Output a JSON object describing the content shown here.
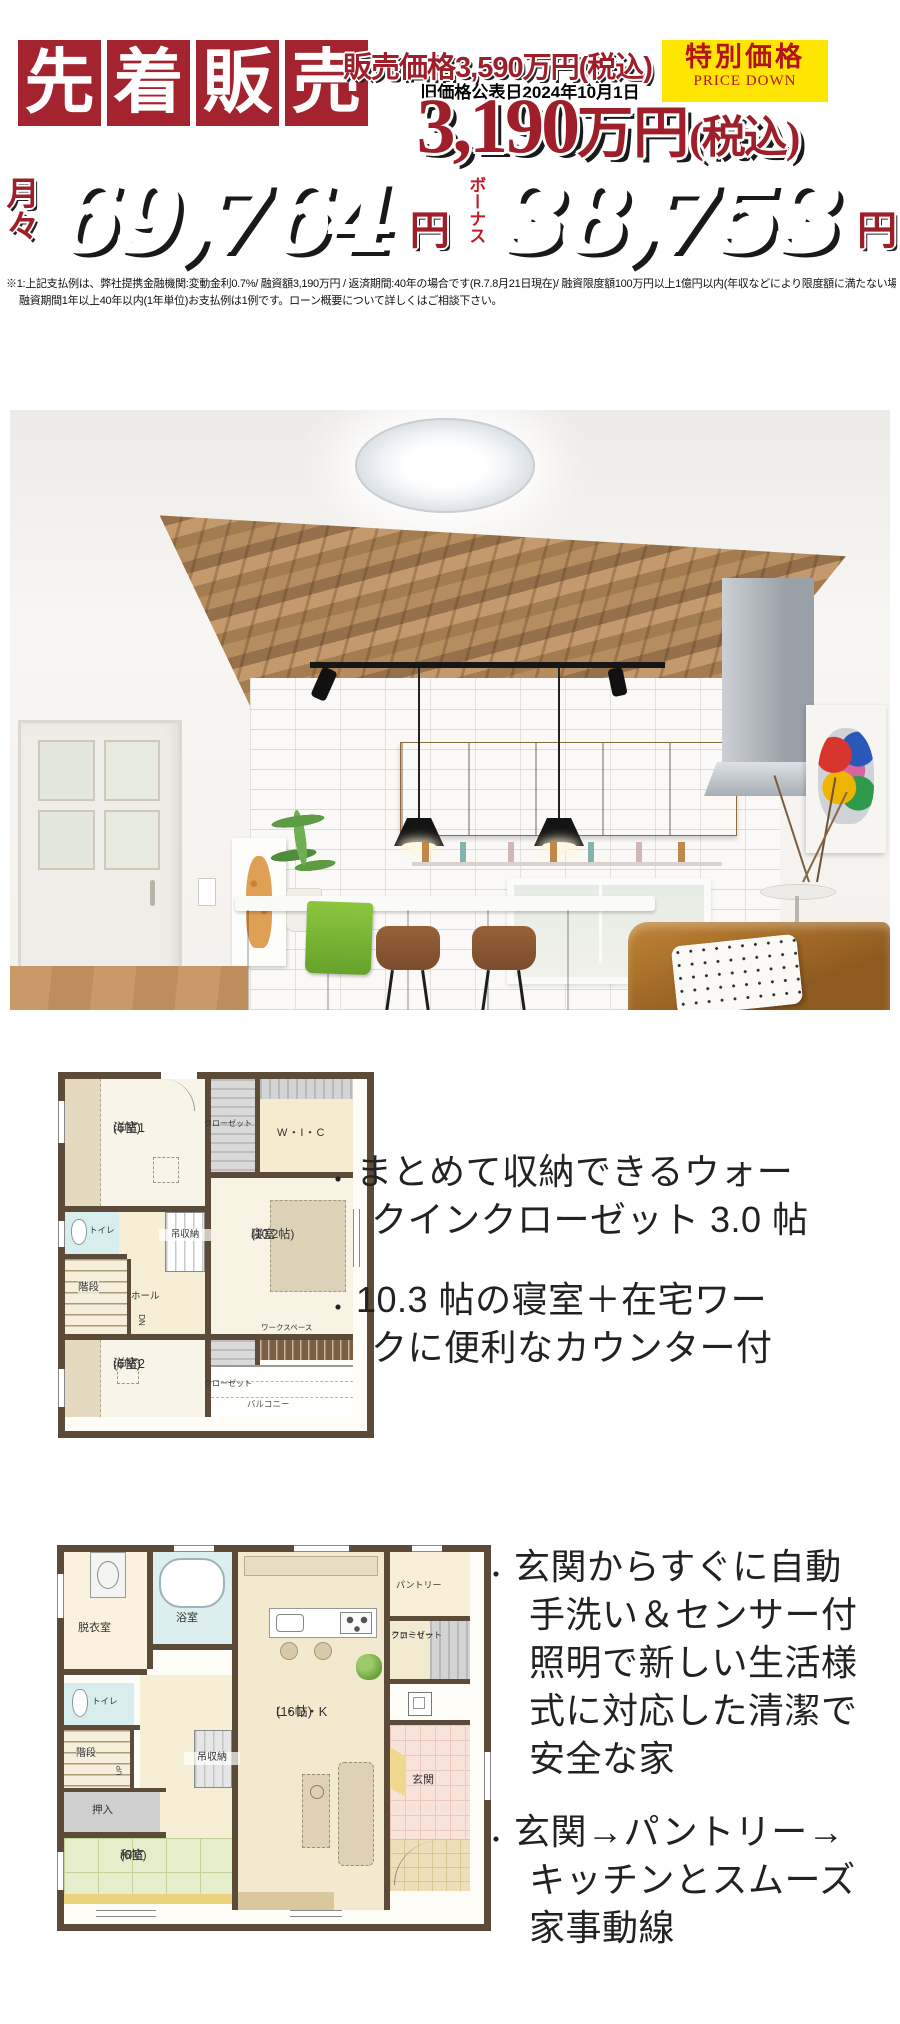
{
  "header": {
    "sale_chars": [
      "先",
      "着",
      "販",
      "売"
    ],
    "list_price": "販売価格3,590万円(税込)",
    "old_price_note": "旧価格公表日2024年10月1日",
    "special_price": "特別価格",
    "price_down": "PRICE DOWN",
    "new_price_amount": "3,190",
    "new_price_unit": "万円",
    "new_price_tax": "(税込)",
    "monthly_label": "月々",
    "monthly_amount": "69,764",
    "monthly_unit": "円",
    "bonus_label": "ボーナス",
    "bonus_amount": "38,753",
    "bonus_unit": "円",
    "disclaimer_line1": "※1:上記支払例は、弊社提携金融機関:変動金利0.7%/ 融資額3,190万円 / 返済期間:40年の場合です(R.7.8月21日現在)/ 融資限度額100万円以上1億円以内(年収などにより限度額に満たない場合もございます)",
    "disclaimer_line2": "融資期間1年以上40年以内(1年単位)お支払例は1例です。ローン概要について詳しくはご相談下さい。"
  },
  "plan_2f": {
    "yoshitsu1": "洋室1",
    "yoshitsu1_size": "(6帖)",
    "closet_top": "クローゼット",
    "wic": "W・I・C",
    "shinshitsu": "寝室",
    "shinshitsu_size": "(10.2帖)",
    "toilet": "トイレ",
    "kaidan": "階段",
    "hall": "ホール",
    "dn": "DN",
    "tsurishuno": "吊収納",
    "yoshitsu2": "洋室2",
    "yoshitsu2_size": "(6帖)",
    "closet_bottom": "クローゼット",
    "workspace": "ワークスペース",
    "balcony": "バルコニー"
  },
  "features_2f": {
    "bullet": "・",
    "item1": [
      "まとめて収納できるウォー",
      "クインクローゼット 3.0 帖"
    ],
    "item2": [
      "10.3 帖の寝室＋在宅ワー",
      "クに便利なカウンター付"
    ]
  },
  "plan_1f": {
    "datsuishitsu": "脱衣室",
    "yokushitsu": "浴室",
    "toilet": "トイレ",
    "kaidan": "階段",
    "up": "UP",
    "oshiire": "押入",
    "washitsu": "和室",
    "washitsu_size": "(6帖)",
    "tsurishuno": "吊収納",
    "ldk": "L・D・K",
    "ldk_size": "(16帖)",
    "pantry": "パントリー",
    "family_closet_line1": "ファミリー",
    "family_closet_line2": "クローゼット",
    "genkan": "玄関"
  },
  "features_1f": {
    "bullet": "・",
    "item1": [
      "玄関からすぐに自動",
      "手洗い＆センサー付",
      "照明で新しい生活様",
      "式に対応した清潔で",
      "安全な家"
    ],
    "item2": [
      "玄関→パントリー→",
      "キッチンとスムーズ",
      "家事動線"
    ]
  },
  "colors": {
    "crimson": "#a3232e",
    "price_yellow": "#ffe600",
    "digit_orange": "#e2582a",
    "digit_dark_red": "#8d181c",
    "wall_brown": "#5c4b38",
    "tatami_green": "#e6edcb",
    "water_blue": "#d8edee",
    "genkan_pink": "#f8e3da"
  }
}
